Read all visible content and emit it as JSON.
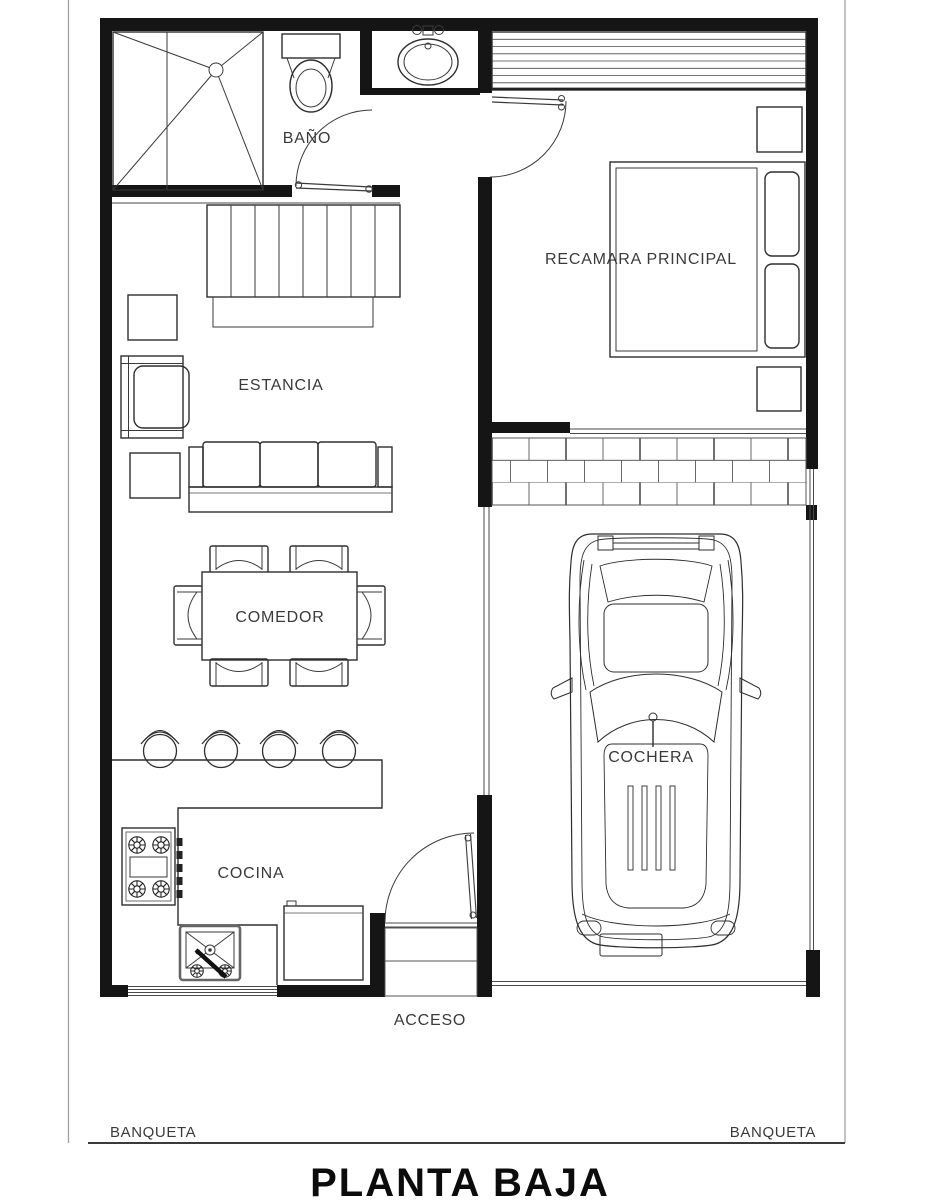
{
  "sheet": {
    "title": "PLANTA BAJA",
    "sidewalk_left": "BANQUETA",
    "sidewalk_right": "BANQUETA"
  },
  "rooms": {
    "bathroom": "BAÑO",
    "master_bedroom": "RECAMARA PRINCIPAL",
    "living_room": "ESTANCIA",
    "dining_room": "COMEDOR",
    "kitchen": "COCINA",
    "garage": "COCHERA",
    "entrance": "ACCESO"
  },
  "colors": {
    "wall": "#151515",
    "furniture_line": "#2e2e2e",
    "text": "#3a3a3a",
    "background": "#ffffff"
  }
}
